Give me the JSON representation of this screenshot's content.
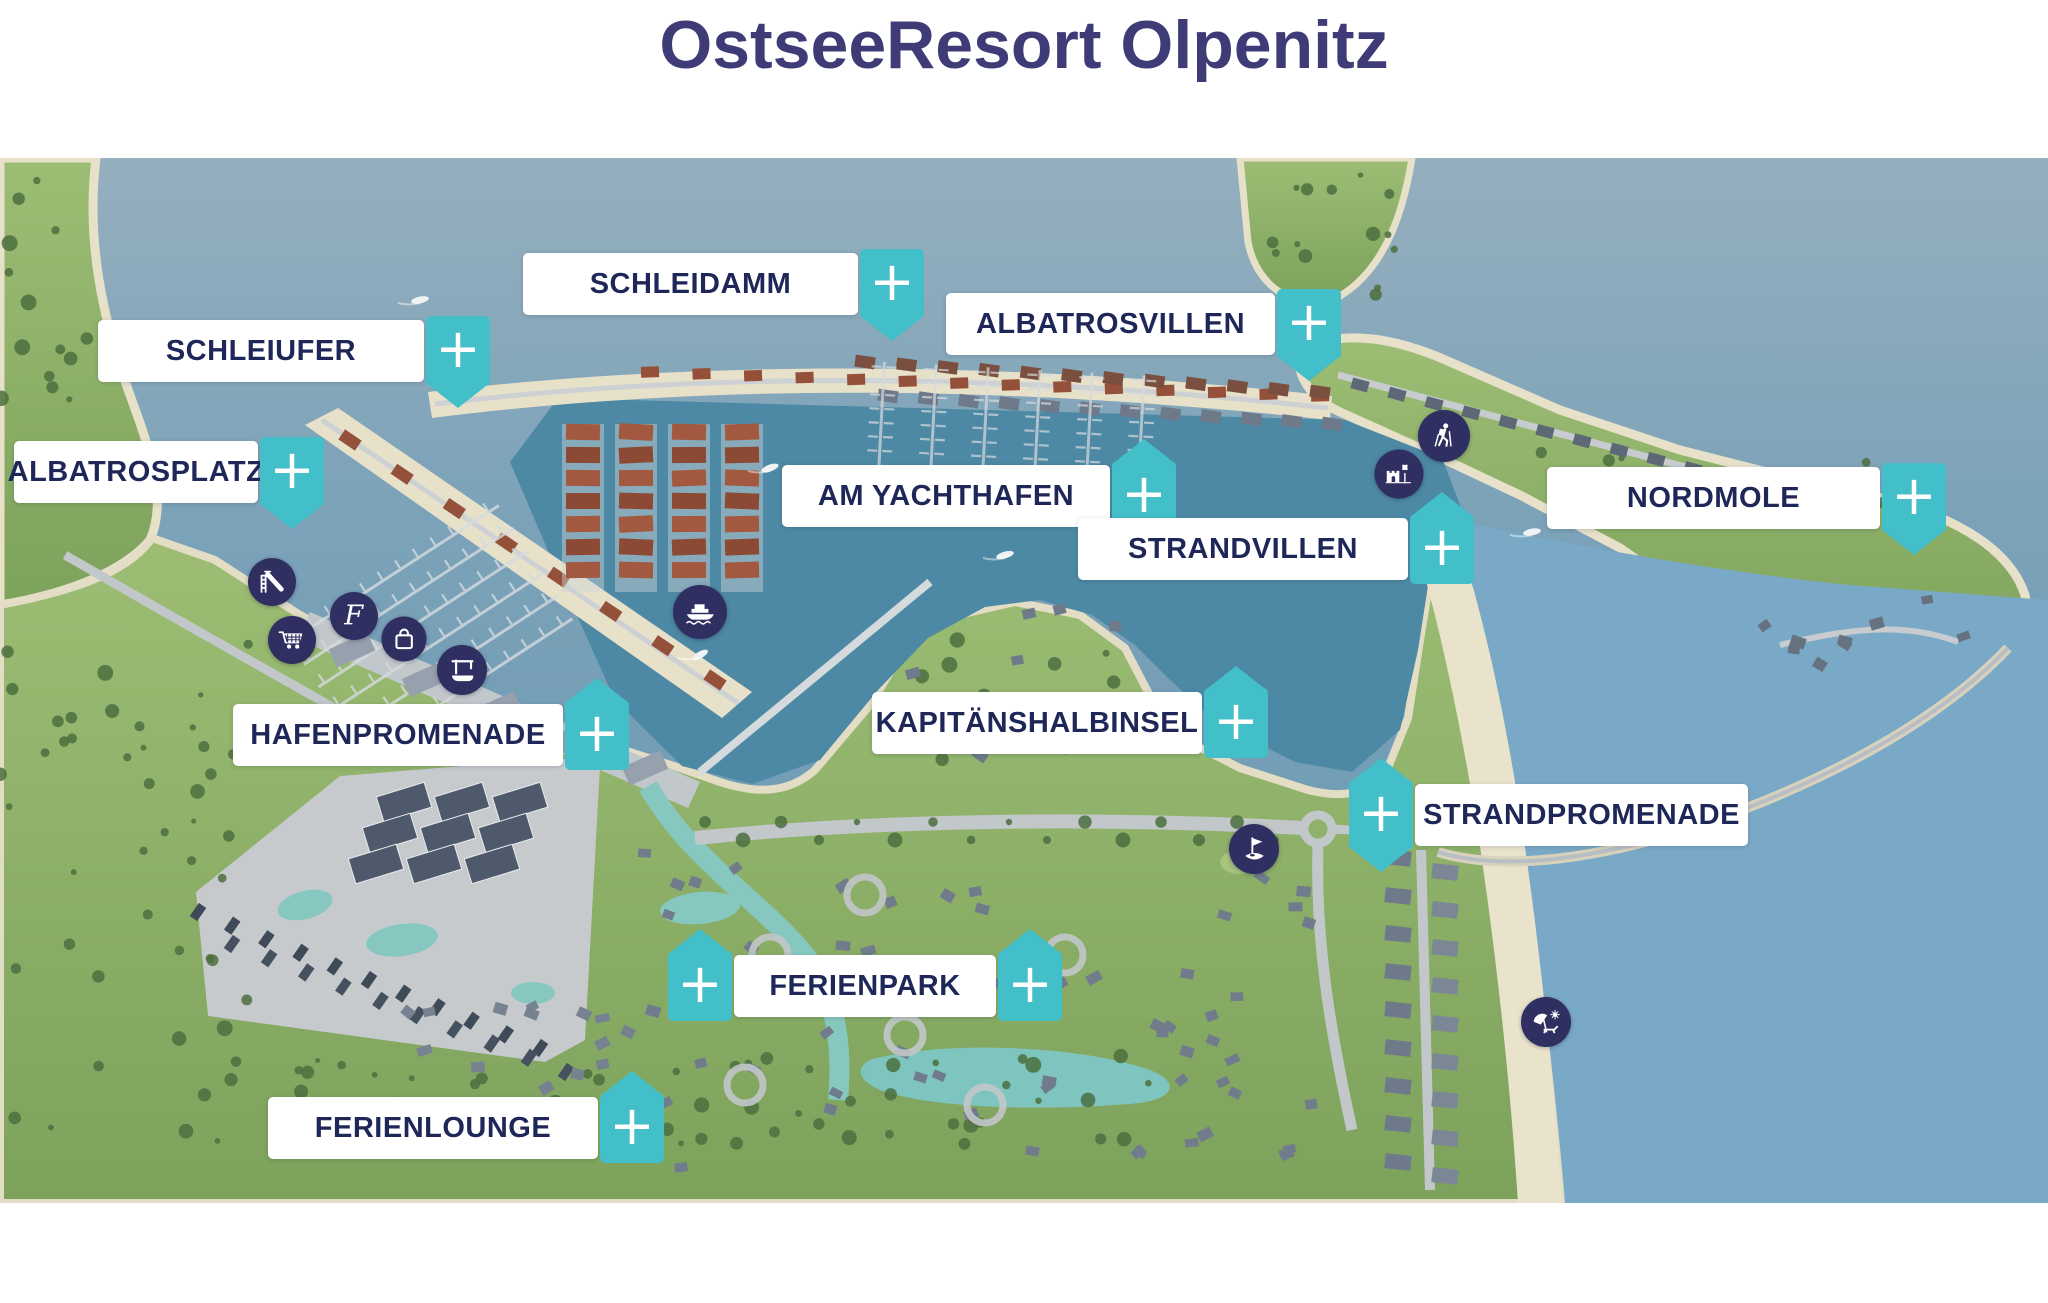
{
  "title": "OstseeResort Olpenitz",
  "ui": {
    "plus": "+"
  },
  "labels": [
    {
      "id": "schleidamm",
      "text": "SCHLEIDAMM"
    },
    {
      "id": "schleiufer",
      "text": "SCHLEIUFER"
    },
    {
      "id": "albatrosplatz",
      "text": "ALBATROSPLATZ"
    },
    {
      "id": "albatrosvillen",
      "text": "ALBATROSVILLEN"
    },
    {
      "id": "am-yachthafen",
      "text": "AM YACHTHAFEN"
    },
    {
      "id": "nordmole",
      "text": "NORDMOLE"
    },
    {
      "id": "strandvillen",
      "text": "STRANDVILLEN"
    },
    {
      "id": "kapitaenshalbinsel",
      "text": "KAPITÄNSHALBINSEL"
    },
    {
      "id": "hafenpromenade",
      "text": "HAFENPROMENADE"
    },
    {
      "id": "strandpromenade",
      "text": "STRANDPROMENADE"
    },
    {
      "id": "ferienpark",
      "text": "FERIENPARK"
    },
    {
      "id": "ferienlounge",
      "text": "FERIENLOUNGE"
    }
  ],
  "map_icons": [
    {
      "id": "waterslide-icon",
      "meaning": "playground slide"
    },
    {
      "id": "script-f-icon",
      "meaning": "restaurant F logo"
    },
    {
      "id": "shopping-cart-icon",
      "meaning": "supermarket"
    },
    {
      "id": "shopping-bag-icon",
      "meaning": "shopping"
    },
    {
      "id": "boat-crane-icon",
      "meaning": "boat crane"
    },
    {
      "id": "ferry-icon",
      "meaning": "ferry"
    },
    {
      "id": "hiker-icon",
      "meaning": "hiking"
    },
    {
      "id": "sandcastle-icon",
      "meaning": "sandcastle playground"
    },
    {
      "id": "golf-icon",
      "meaning": "golf"
    },
    {
      "id": "beach-icon",
      "meaning": "beach"
    }
  ],
  "colors": {
    "accent_teal": "#43bfca",
    "marker_navy": "#302f61",
    "label_text": "#1e2758",
    "title_text": "#3e3b77",
    "water": "#6d9cb6",
    "harbour_basin": "#4d89a4",
    "land_green": "#8aab61",
    "sand": "#e9e3cc"
  }
}
